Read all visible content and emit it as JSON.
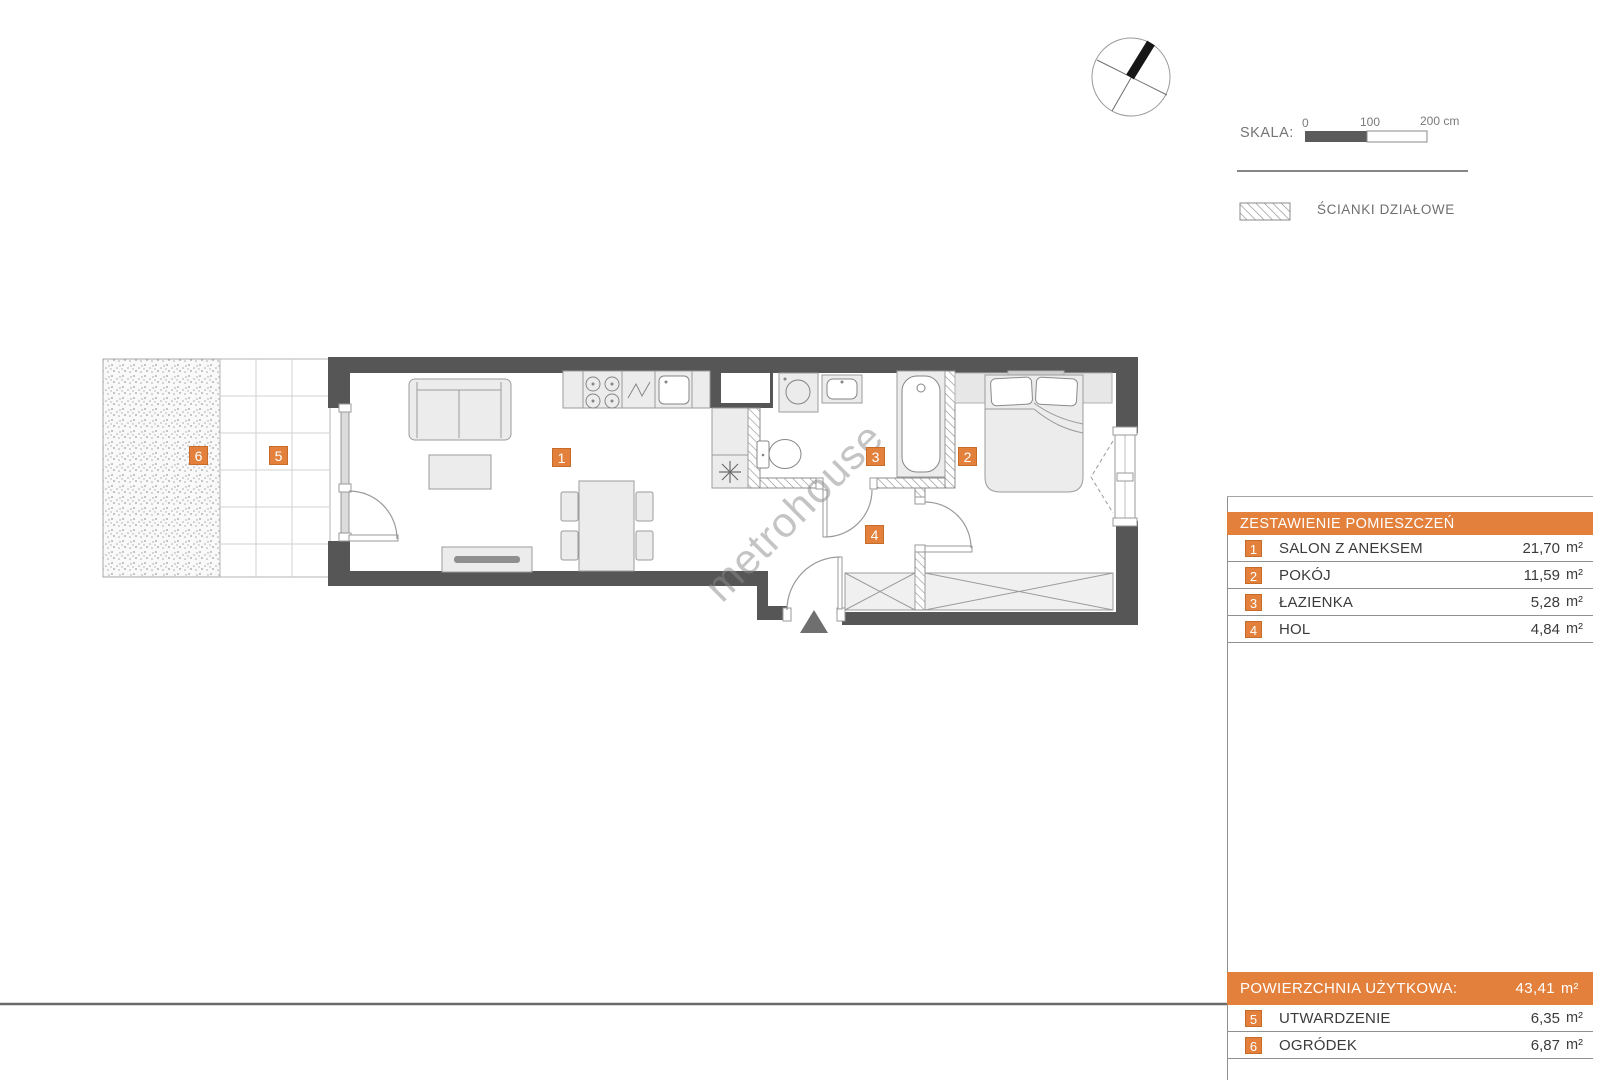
{
  "watermark": "metrohouse",
  "scalebar": {
    "label": "SKALA:",
    "tick0": "0",
    "tick100": "100",
    "tick200": "200 cm"
  },
  "legend": {
    "partition_walls": "ŚCIANKI DZIAŁOWE"
  },
  "badges": {
    "b1": "1",
    "b2": "2",
    "b3": "3",
    "b4": "4",
    "b5": "5",
    "b6": "6"
  },
  "rooms_table": {
    "title": "ZESTAWIENIE POMIESZCZEŃ",
    "rows": [
      {
        "num": "1",
        "name": "SALON Z ANEKSEM",
        "area": "21,70",
        "unit": "m²"
      },
      {
        "num": "2",
        "name": "POKÓJ",
        "area": "11,59",
        "unit": "m²"
      },
      {
        "num": "3",
        "name": "ŁAZIENKA",
        "area": "5,28",
        "unit": "m²"
      },
      {
        "num": "4",
        "name": "HOL",
        "area": "4,84",
        "unit": "m²"
      }
    ]
  },
  "summary_table": {
    "title": "POWIERZCHNIA UŻYTKOWA:",
    "area": "43,41",
    "unit": "m²",
    "rows": [
      {
        "num": "5",
        "name": "UTWARDZENIE",
        "area": "6,35",
        "unit": "m²"
      },
      {
        "num": "6",
        "name": "OGRÓDEK",
        "area": "6,87",
        "unit": "m²"
      }
    ]
  },
  "colors": {
    "accent": "#E2803C",
    "accent_border": "#C66C2B",
    "wall": "#565656"
  }
}
